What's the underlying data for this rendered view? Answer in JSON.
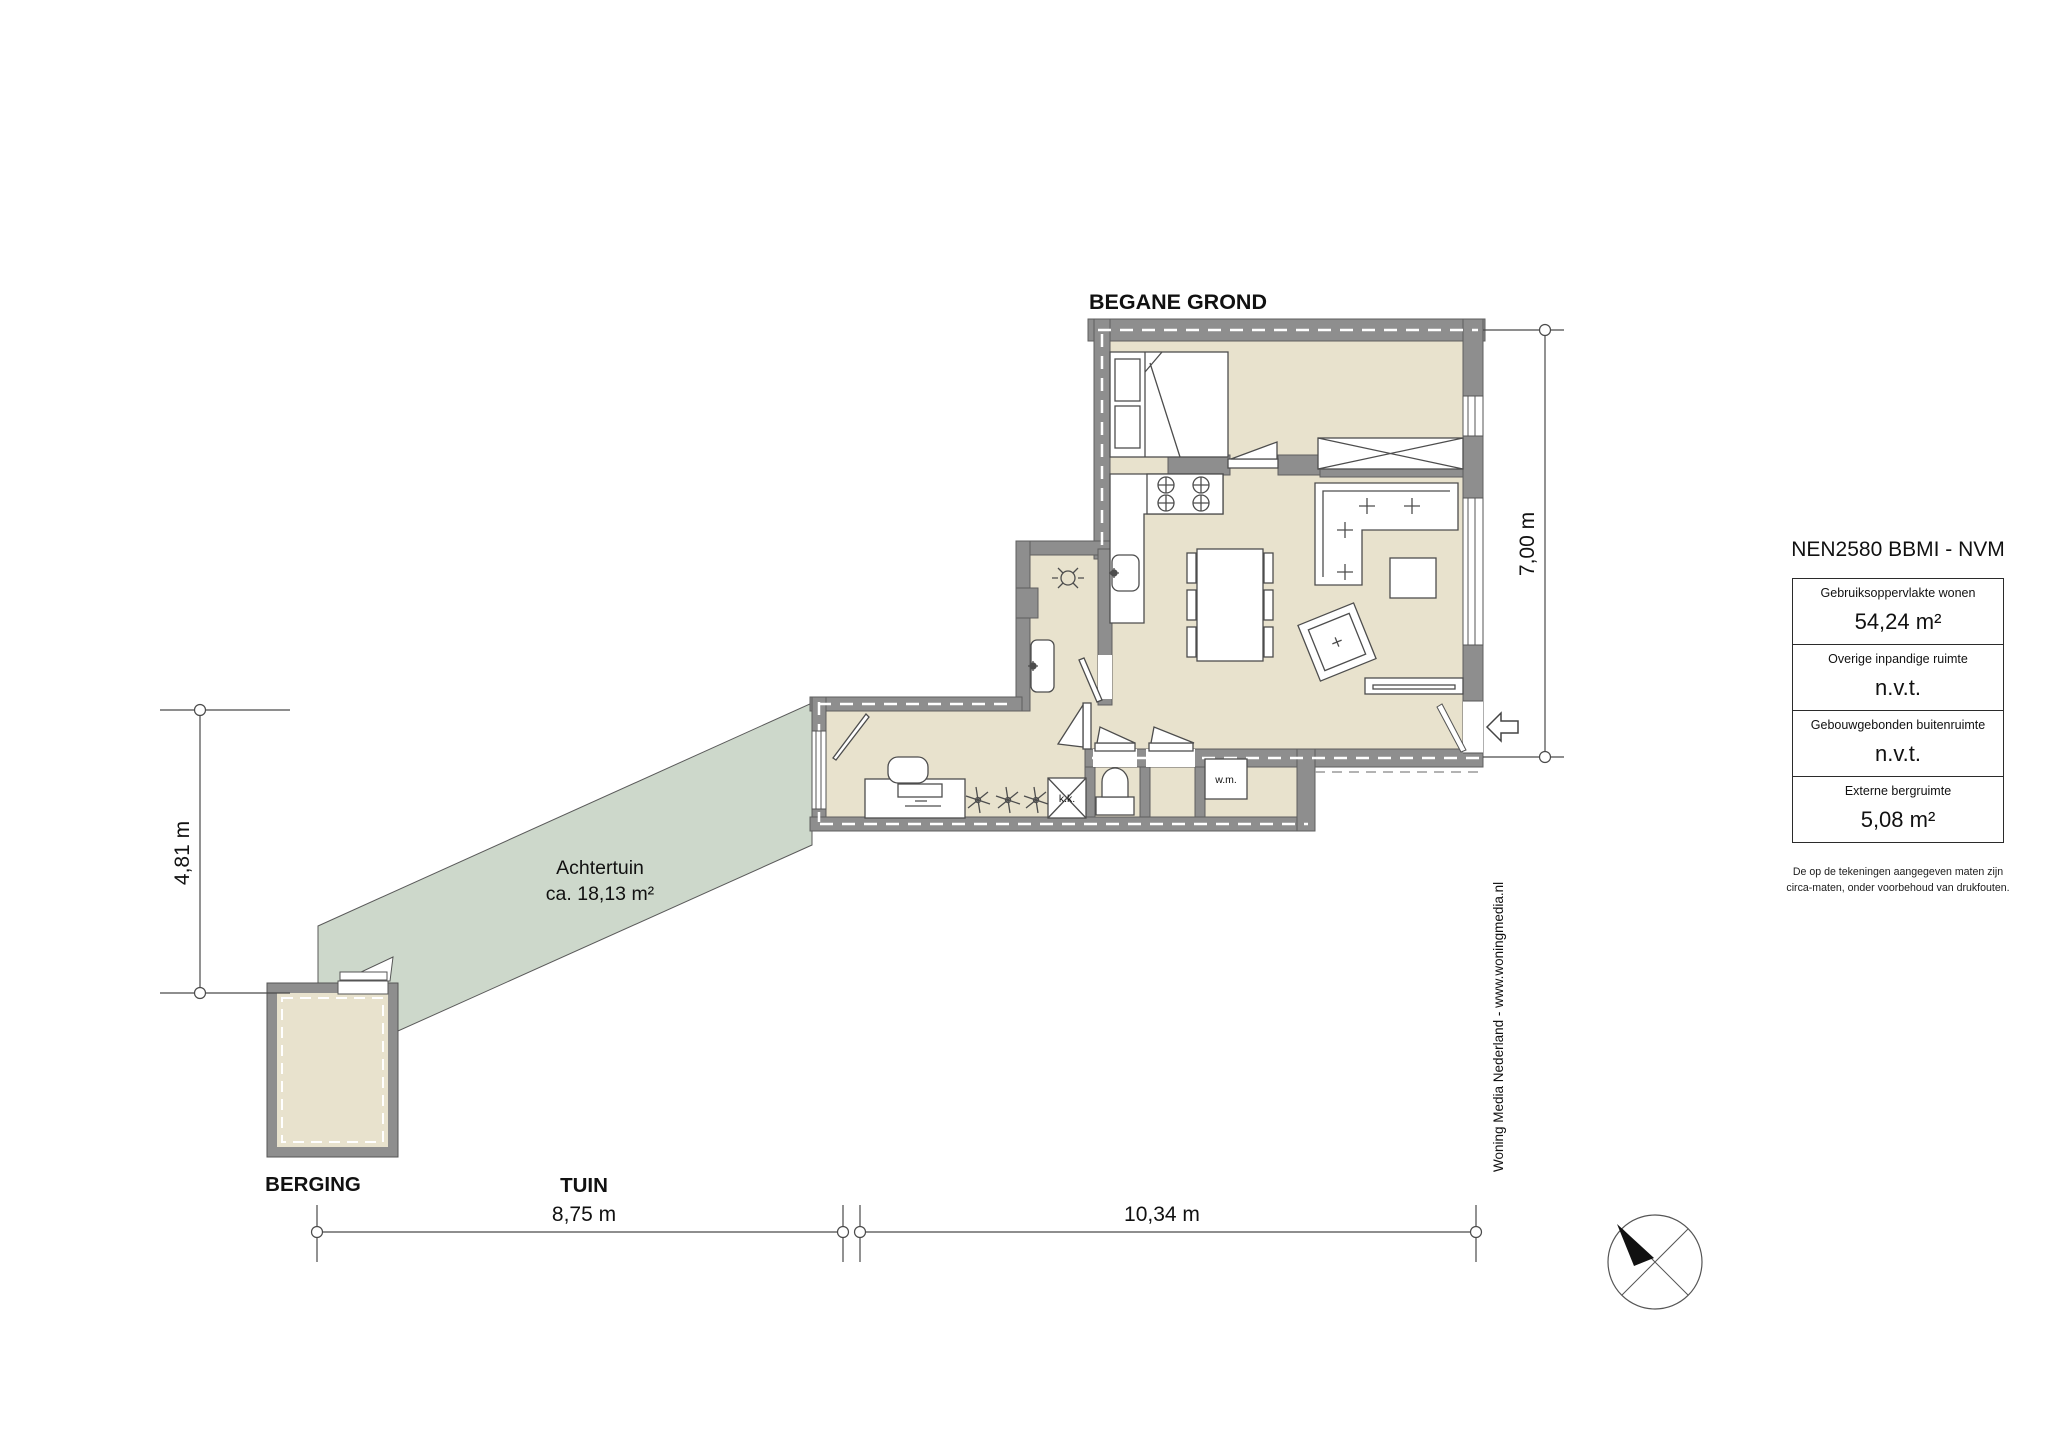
{
  "title": "BEGANE GROND",
  "labels": {
    "berging": "BERGING",
    "tuin": "TUIN",
    "garden_name": "Achtertuin",
    "garden_area": "ca. 18,13 m²",
    "washing_machine": "w.m.",
    "hatch": "k.k."
  },
  "dimensions": {
    "garden_width": "8,75 m",
    "house_width": "10,34 m",
    "garden_depth": "4,81 m",
    "house_depth": "7,00 m"
  },
  "legend": {
    "title": "NEN2580 BBMI - NVM",
    "rows": [
      {
        "label": "Gebruiksoppervlakte wonen",
        "value": "54,24 m²"
      },
      {
        "label": "Overige inpandige ruimte",
        "value": "n.v.t."
      },
      {
        "label": "Gebouwgebonden buitenruimte",
        "value": "n.v.t."
      },
      {
        "label": "Externe bergruimte",
        "value": "5,08 m²"
      }
    ],
    "disclaimer_line1": "De op de tekeningen aangegeven maten zijn",
    "disclaimer_line2": "circa-maten, onder voorbehoud van drukfouten."
  },
  "credit": "Woning Media Nederland - www.woningmedia.nl",
  "colors": {
    "floor": "#e8e2cd",
    "wall": "#8e8e8e",
    "garden": "#cdd8cb",
    "line": "#4a4a4a"
  }
}
